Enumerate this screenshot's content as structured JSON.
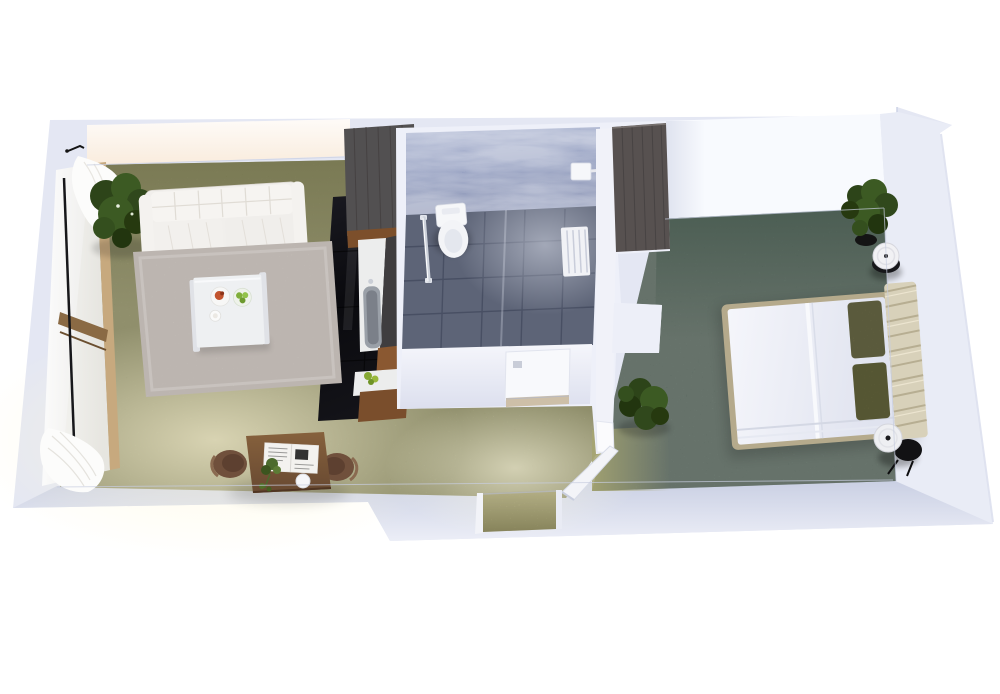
{
  "scene": {
    "type": "3d-floor-plan-render",
    "view": "top-down-oblique",
    "background": "#ffffff",
    "rooms": [
      {
        "name": "living-room",
        "floor": "olive-green carpet",
        "contents": [
          "white tufted sofa",
          "corner potted plant",
          "beige area rug",
          "white coffee table",
          "plate of food",
          "bowl of green fruit",
          "wooden desk",
          "two brown chairs",
          "newspaper",
          "desk plant",
          "white vase",
          "window wall with wood frame",
          "white curtains top",
          "white curtains bottom",
          "door stop fixture"
        ]
      },
      {
        "name": "kitchen",
        "floor": "black gloss tile",
        "contents": [
          "tall dark cabinet",
          "counter with sink",
          "wood counter front",
          "green fruit on counter"
        ]
      },
      {
        "name": "bathroom",
        "floor": "slate grey tile",
        "contents": [
          "toilet",
          "towel rail",
          "shower control unit",
          "slatted shower mat",
          "white bathroom door"
        ]
      },
      {
        "name": "bedroom",
        "floor": "sage green carpet",
        "contents": [
          "double bed with white duvet",
          "channel tufted headboard",
          "two olive pillows",
          "dark wood wardrobe",
          "round side table north",
          "round side table south",
          "corner plant",
          "floor plant by door",
          "open white door"
        ]
      },
      {
        "name": "entry",
        "floor": "olive-green carpet",
        "contents": [
          "doorway opening in south wall"
        ]
      }
    ],
    "palette": {
      "page_bg": "#ffffff",
      "wall_base": "#e4e7f3",
      "wall_top_light": "#eef0f8",
      "wall_face_south_dark": "#c9cfe3",
      "wall_inner_white": "#f8fafe",
      "living_glow_warm": "#fdf2e7",
      "carpet_olive": "#a6a572",
      "carpet_sage": "#75897c",
      "rug_beige": "#cdc6c0",
      "kitchen_floor_black": "#101016",
      "cabinet_dark": "#525051",
      "wardrobe_wood": "#575150",
      "counter_wood": "#8a5831",
      "counter_top_white": "#eceded",
      "bath_wall_blue": "#a7b0cc",
      "bath_floor_slate": "#5d6477",
      "fixture_white": "#f4f5f8",
      "sofa_white": "#f1efec",
      "table_white": "#eef0f2",
      "bed_frame_tan": "#b5aa8c",
      "headboard_beige": "#d8d1ba",
      "pillow_olive": "#8c8b5d",
      "duvet_white": "#edeff6",
      "plant_green": "#3c5a23",
      "desk_wood": "#7b5a40",
      "chair_brown": "#70503c",
      "door_white": "#f8f9fc",
      "chrome": "#ced3dc"
    }
  }
}
